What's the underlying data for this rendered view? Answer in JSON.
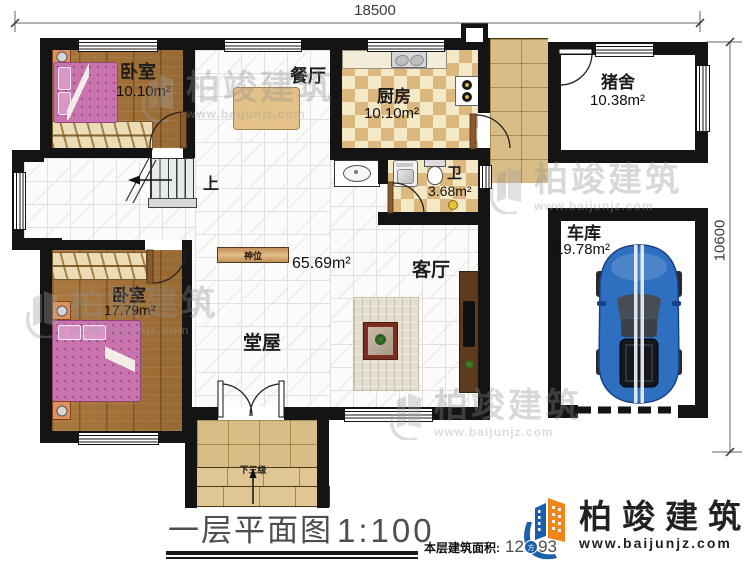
{
  "dimensions": {
    "top_width": "18500",
    "right_height": "10600"
  },
  "rooms": {
    "bedroom1": {
      "name": "卧室",
      "area": "10.10m²"
    },
    "dining": {
      "name": "餐厅"
    },
    "kitchen": {
      "name": "厨房",
      "area": "10.10m²"
    },
    "pigpen": {
      "name": "猪舍",
      "area": "10.38m²"
    },
    "bathroom": {
      "name": "卫",
      "area": "3.68m²"
    },
    "garage": {
      "name": "车库",
      "area": "19.78m²"
    },
    "bedroom2": {
      "name": "卧室",
      "area": "17.79m²"
    },
    "hall": {
      "name": "堂屋"
    },
    "living": {
      "name": "客厅"
    },
    "hall_living_area": "65.69m²"
  },
  "annotations": {
    "stairs_up": "上",
    "shrine": "神位",
    "entry_steps": "下三级"
  },
  "footer": {
    "title": "一层平面图",
    "scale": "1:100",
    "area_label": "本层建筑面积:",
    "area_value": "129.93"
  },
  "brand": {
    "name": "柏竣建筑",
    "website": "www.baijunjz.com"
  },
  "watermark": {
    "name": "柏竣建筑",
    "website": "www.baijunjz.com"
  },
  "colors": {
    "wall": "#141414",
    "wood_floor": "#a5743d",
    "bed_pink": "#c873ae",
    "checker_tan": "#ddb87e",
    "checker_cream": "#f4e9c6",
    "paving": "#d8bd86",
    "car_blue": "#2f6fc0",
    "brand_blue": "#1b5ea9",
    "brand_orange": "#f08519"
  }
}
